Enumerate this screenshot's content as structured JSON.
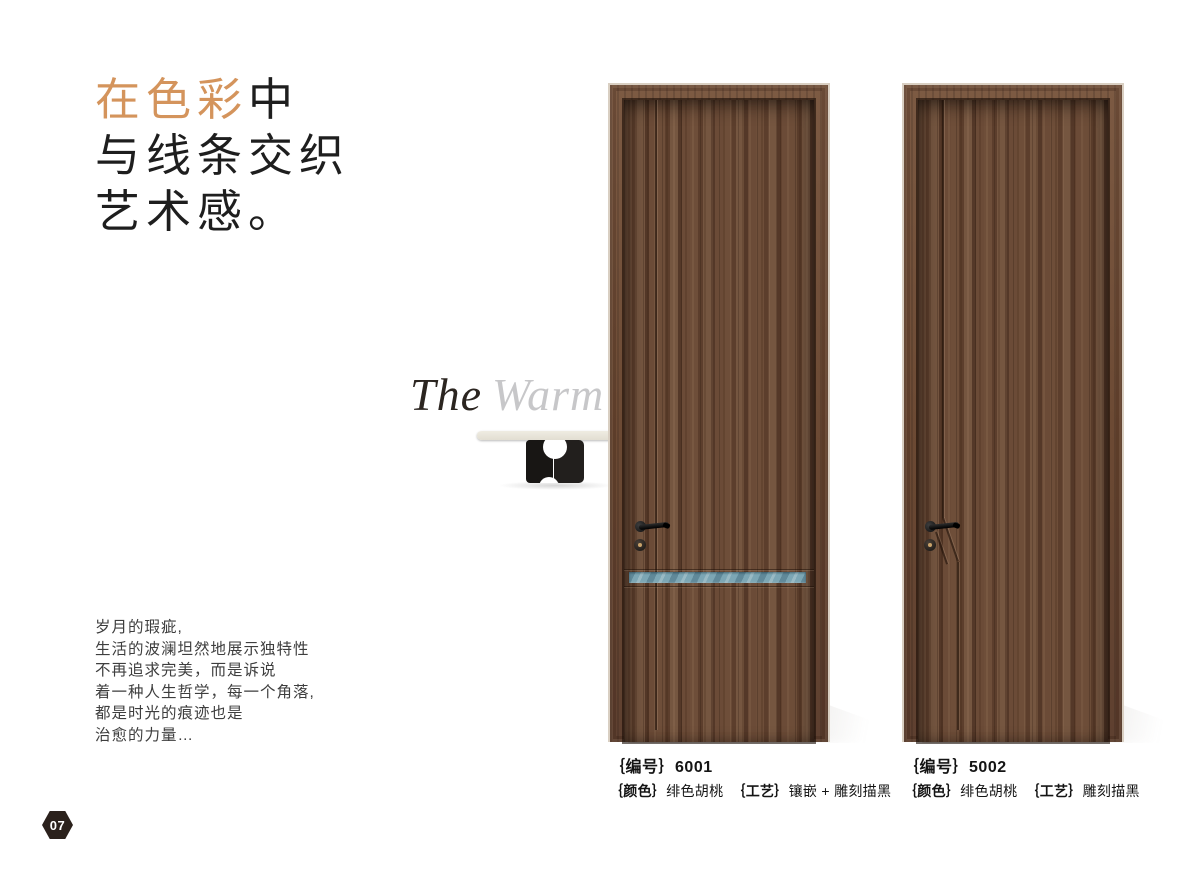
{
  "page": {
    "number": "07"
  },
  "heading": {
    "accent_text": "在色彩",
    "line1_rest": "中",
    "line2": "与线条交织",
    "line3": "艺术感。"
  },
  "subtitle": {
    "word1": "The",
    "word2": "Warm"
  },
  "intro": {
    "lines": [
      "岁月的瑕疵,",
      "生活的波澜坦然地展示独特性",
      "不再追求完美，而是诉说",
      "着一种人生哲学，每一个角落,",
      "都是时光的痕迹也是",
      "治愈的力量…"
    ]
  },
  "doors": [
    {
      "code_label": "｛编号｝",
      "code": "6001",
      "color_label": "｛颜色｝",
      "color_value": "绯色胡桃",
      "craft_label": "｛工艺｝",
      "craft_value": "镶嵌 + 雕刻描黑"
    },
    {
      "code_label": "｛编号｝",
      "code": "5002",
      "color_label": "｛颜色｝",
      "color_value": "绯色胡桃",
      "craft_label": "｛工艺｝",
      "craft_value": "雕刻描黑"
    }
  ],
  "colors": {
    "accent_orange": "#d4945c",
    "heading_black": "#1e1e1e",
    "wood_brown": "#6b4b37",
    "wood_dark": "#543828",
    "inlay_blue": "#7ca6b4",
    "badge_brown": "#2b211c",
    "subtitle_gray": "#c7c7c9"
  }
}
